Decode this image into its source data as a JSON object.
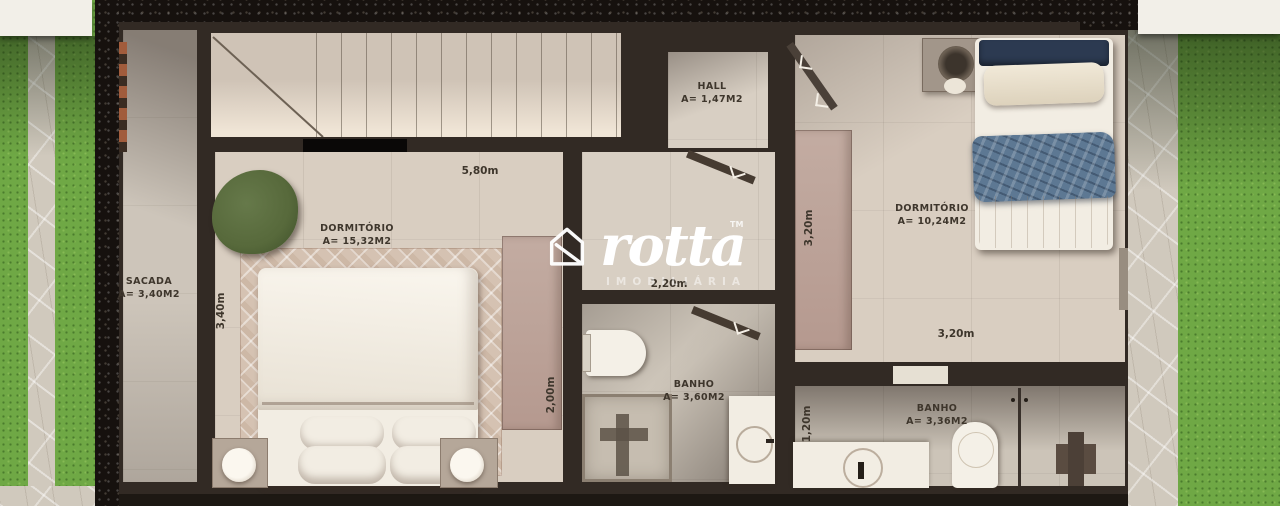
{
  "brand": {
    "name": "rotta",
    "tm": "TM",
    "tagline": "IMOBILIÁRIA"
  },
  "rooms": {
    "sacada": {
      "name": "SACADA",
      "area": "A= 3,40M2"
    },
    "hall": {
      "name": "HALL",
      "area": "A= 1,47M2"
    },
    "dormitorio_left": {
      "name": "DORMITÓRIO",
      "area": "A= 15,32M2"
    },
    "banho_center": {
      "name": "BANHO",
      "area": "A= 3,60M2"
    },
    "dormitorio_right": {
      "name": "DORMITÓRIO",
      "area": "A= 10,24M2"
    },
    "banho_right": {
      "name": "BANHO",
      "area": "A= 3,36M2"
    }
  },
  "dimensions": {
    "stairs_width": "5,80m",
    "dorm_left_height": "3,40m",
    "hall_width": "2,20m",
    "closet_depth": "2,00m",
    "dorm_right_height": "3,20m",
    "dorm_right_width": "3,20m",
    "banho_right_height": "1,20m"
  },
  "colors": {
    "wall": "#322a24",
    "wall_dark": "#1d1813",
    "gravel": "#16110e",
    "floor": "#d8cfc3",
    "floor_warm": "#d9cec1",
    "sacada": "#cdc5ba",
    "rug": "#d5c2b2",
    "grass": "#6fa845",
    "path": "#d0c9bd",
    "closet_pink": "#c3aca2",
    "fabric_white": "#f2ede3",
    "blanket_blue": "#5d7893",
    "blanket_navy": "#2c3a51",
    "armchair_green": "#57693b",
    "label_text": "#3e362c",
    "logo_white": "#ffffff"
  }
}
